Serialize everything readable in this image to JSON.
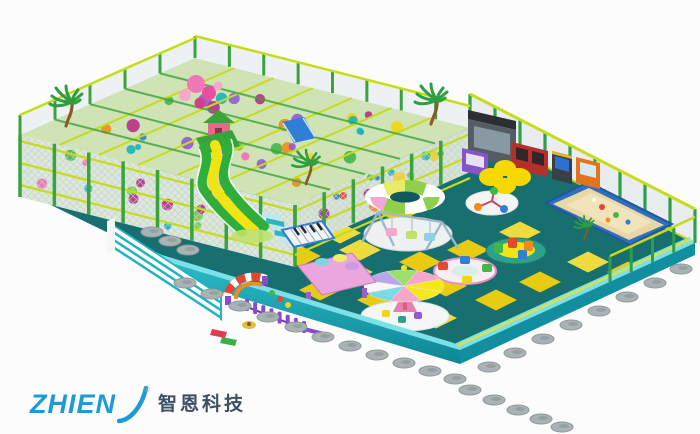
{
  "alt": "3D render of a children's indoor playground: green-framed multi-level soft play structure with palm trees and a wavy slide, teal floor with yellow mats, carousel rides, sand pit, arcade machines and ZHIEN company logo",
  "logo": {
    "brand": "ZHIEN",
    "registered_mark": "®",
    "company_name": "智恩科技"
  },
  "palette": {
    "background": "#fcfcfd",
    "floor": "#186f70",
    "floor_dark": "#10595d",
    "wall": "#1fb0bd",
    "wall_dark": "#118fa0",
    "wall_light": "#7ce0e8",
    "mat": "#f0cf10",
    "mat_light": "#f7e13c",
    "structure_green": "#3aa33c",
    "rail_yellow": "#c6dc1a",
    "net": "#c3ced4",
    "slide_green": "#2fae3a",
    "slide_yellow": "#f2e412",
    "sand": "#e9d7a4",
    "sand_light": "#f2e6c0",
    "sand_border": "#2f6fc0",
    "disc": "#aab3b3",
    "pink": "#f06eb4",
    "purple": "#8e5bd1",
    "blue": "#2f7fd6",
    "orange": "#f08c1e",
    "red": "#e4482e",
    "green": "#41b649",
    "logo_blue": "#1e9bd7",
    "logo_dark": "#3d4f63"
  }
}
